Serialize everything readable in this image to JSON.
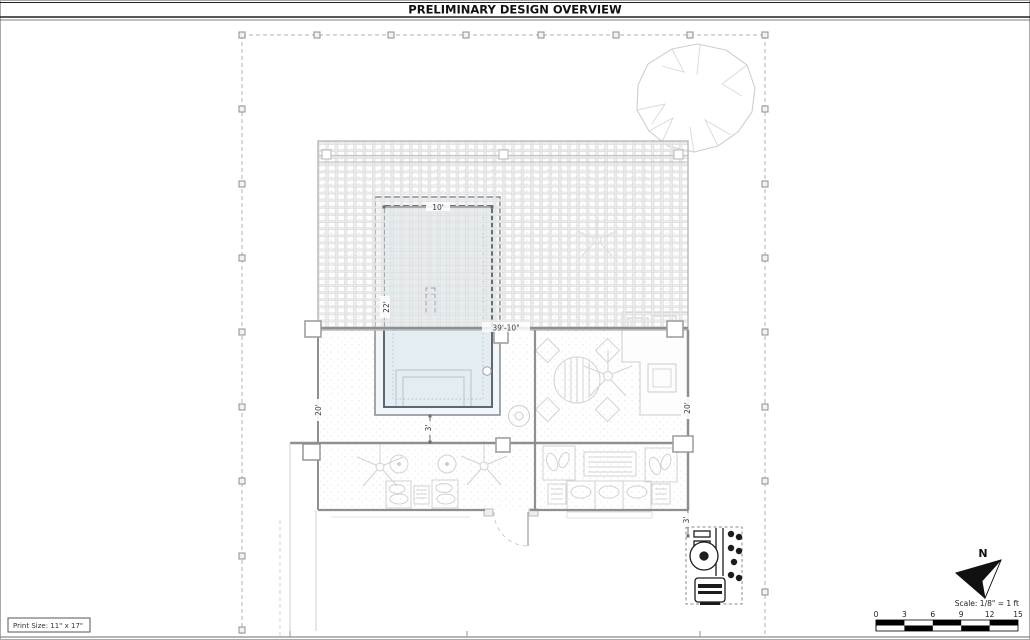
{
  "title": "PRELIMINARY DESIGN OVERVIEW",
  "print_info": {
    "label": "Print Size: 11\" x 17\""
  },
  "scale_bar": {
    "label": "Scale: 1/8\" = 1 ft",
    "ticks": [
      "0",
      "3",
      "6",
      "9",
      "12",
      "15"
    ]
  },
  "north_arrow": {
    "label": "N"
  },
  "dimensions": {
    "pool_width": "10'",
    "pool_length": "22'",
    "overall_width": "39'-10\"",
    "left_depth": "20'",
    "right_depth": "20'",
    "pool_to_wall": "3'",
    "equipment_offset": "3'"
  },
  "colors": {
    "water": "#e4edf2",
    "wall": "#8f8f8f",
    "boundary": "#b0b0b0",
    "lattice": "#e9e9e9",
    "equipment": "#1c1c1c",
    "dim_text": "#3c3c49",
    "title_text": "#111111"
  }
}
